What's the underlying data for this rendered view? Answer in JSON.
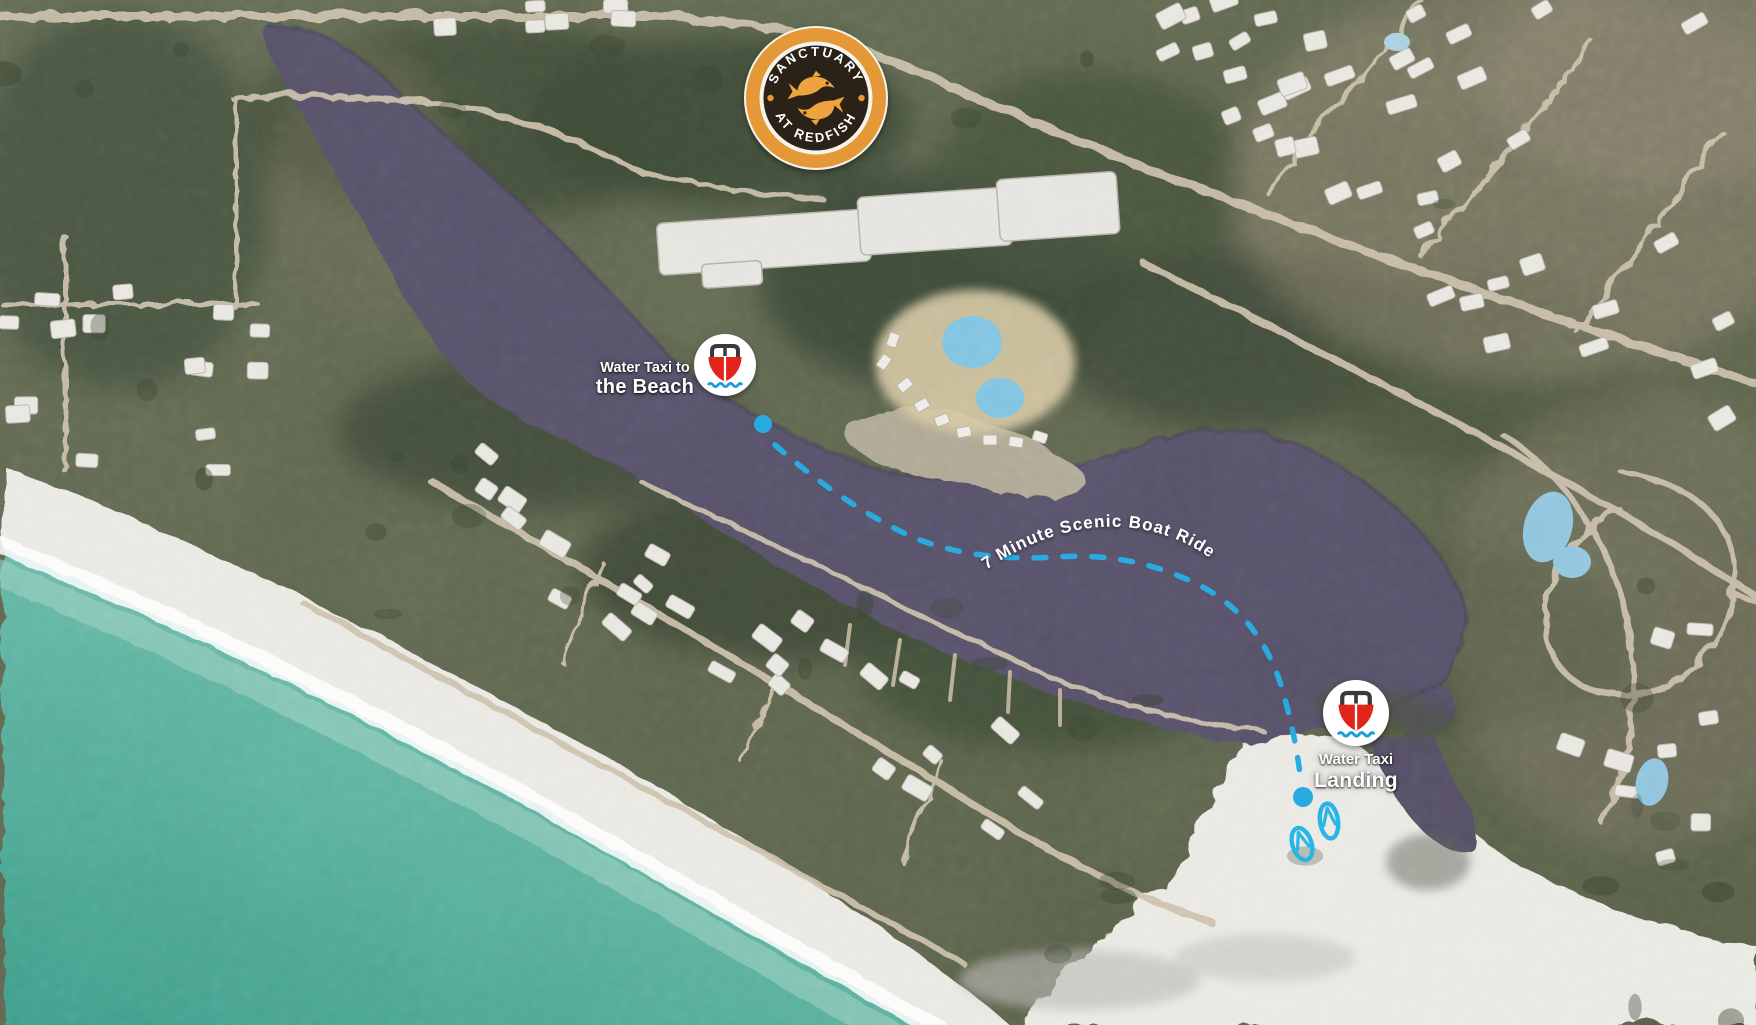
{
  "logo": {
    "top_text": "SANCTUARY",
    "bottom_text": "AT REDFISH",
    "ring_color": "#E59837",
    "badge_color": "#2B2016",
    "text_color": "#FFFFFF",
    "fish_color": "#EFA33F"
  },
  "markers": {
    "beach": {
      "label_small": "Water Taxi to",
      "label_big": "the Beach",
      "cx": "725",
      "cy": "365",
      "r": "31",
      "dot": {
        "cx": "763",
        "cy": "424",
        "r": "9"
      }
    },
    "landing": {
      "label_small": "Water Taxi",
      "label_big": "Landing",
      "cx": "1356",
      "cy": "713",
      "r": "33",
      "dot": {
        "cx": "1303",
        "cy": "797",
        "r": "10"
      }
    }
  },
  "route": {
    "label": "7 Minute Scenic Boat Ride",
    "color": "#29ABE2",
    "dash_path": "M 775,445 C 815,480 860,512 908,535 C 952,555 1005,560 1055,557 C 1102,554 1148,560 1197,584 C 1243,607 1270,645 1283,692 C 1292,723 1298,755 1301,782",
    "label_arc": "M 983,572 C 1040,532 1098,519 1150,531 C 1203,543 1245,579 1272,636"
  },
  "boat_icon": {
    "hull_color": "#E1251B",
    "frame_color": "#3A3A3A",
    "wave_color": "#1F9CD8",
    "circle_color": "#FFFFFF"
  },
  "flip_flops": {
    "color": "#29B5E6"
  },
  "terrain_colors": {
    "lake": "#575167",
    "forest": "#414C38",
    "ocean_deep": "#3E9B87",
    "ocean_mid": "#5FB3A0",
    "ocean_shallow": "#9AD2C2",
    "beach": "#EBE9E4",
    "road": "#CCC0AB",
    "house": "#E9E7E1"
  }
}
